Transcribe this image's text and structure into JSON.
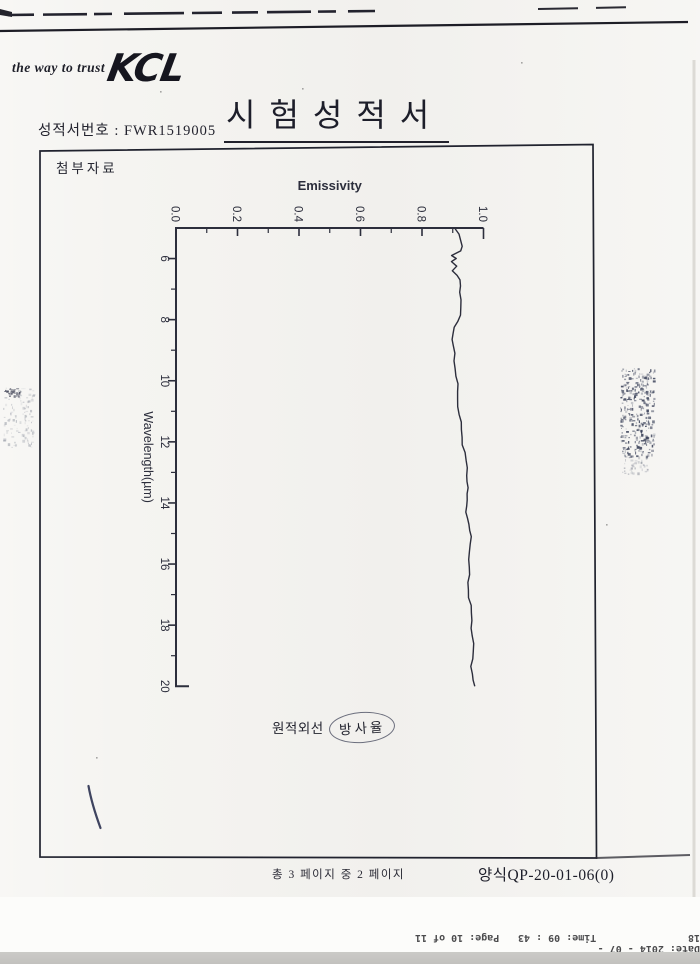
{
  "header": {
    "tagline": "the way to trust",
    "logo_text": "KCL",
    "report_no": "성적서번호 : FWR1519005",
    "title": "시험성적서"
  },
  "attachment_box": {
    "label": "첨부자료"
  },
  "chart_data": {
    "type": "line",
    "title": "",
    "orientation": "rotated: emissivity on top horizontal axis, wavelength on left vertical axis increasing downward",
    "emissivity_axis": {
      "label": "Emissivity",
      "ticks": [
        "0.0",
        "0.2",
        "0.4",
        "0.6",
        "0.8",
        "1.0"
      ],
      "range": [
        0.0,
        1.0
      ],
      "minor_step": 0.1,
      "position": "top"
    },
    "wavelength_axis": {
      "label": "Wavelength(µm)",
      "ticks": [
        "6",
        "8",
        "10",
        "12",
        "14",
        "16",
        "18",
        "20"
      ],
      "range": [
        5,
        20
      ],
      "minor_step": 1,
      "position": "left"
    },
    "grid": false,
    "series": [
      {
        "name": "far-infrared emissivity spectrum",
        "points": [
          [
            5.0,
            0.905
          ],
          [
            5.2,
            0.916
          ],
          [
            5.4,
            0.925
          ],
          [
            5.6,
            0.931
          ],
          [
            5.75,
            0.927
          ],
          [
            5.9,
            0.9
          ],
          [
            6.0,
            0.915
          ],
          [
            6.1,
            0.897
          ],
          [
            6.25,
            0.91
          ],
          [
            6.4,
            0.896
          ],
          [
            6.55,
            0.913
          ],
          [
            6.7,
            0.922
          ],
          [
            6.9,
            0.926
          ],
          [
            7.1,
            0.927
          ],
          [
            7.35,
            0.926
          ],
          [
            7.6,
            0.925
          ],
          [
            7.85,
            0.922
          ],
          [
            8.05,
            0.917
          ],
          [
            8.25,
            0.909
          ],
          [
            8.45,
            0.902
          ],
          [
            8.65,
            0.898
          ],
          [
            8.85,
            0.9
          ],
          [
            9.1,
            0.904
          ],
          [
            9.35,
            0.907
          ],
          [
            9.6,
            0.909
          ],
          [
            9.85,
            0.912
          ],
          [
            10.1,
            0.913
          ],
          [
            10.35,
            0.915
          ],
          [
            10.6,
            0.917
          ],
          [
            10.85,
            0.919
          ],
          [
            11.1,
            0.921
          ],
          [
            11.35,
            0.924
          ],
          [
            11.6,
            0.928
          ],
          [
            11.85,
            0.931
          ],
          [
            12.1,
            0.935
          ],
          [
            12.35,
            0.938
          ],
          [
            12.6,
            0.942
          ],
          [
            12.85,
            0.945
          ],
          [
            13.1,
            0.948
          ],
          [
            13.3,
            0.95
          ],
          [
            13.5,
            0.949
          ],
          [
            13.7,
            0.946
          ],
          [
            13.9,
            0.944
          ],
          [
            14.1,
            0.943
          ],
          [
            14.3,
            0.946
          ],
          [
            14.5,
            0.95
          ],
          [
            14.7,
            0.953
          ],
          [
            14.9,
            0.955
          ],
          [
            15.1,
            0.956
          ],
          [
            15.35,
            0.957
          ],
          [
            15.6,
            0.956
          ],
          [
            15.85,
            0.954
          ],
          [
            16.1,
            0.953
          ],
          [
            16.35,
            0.951
          ],
          [
            16.6,
            0.95
          ],
          [
            16.85,
            0.952
          ],
          [
            17.1,
            0.955
          ],
          [
            17.35,
            0.957
          ],
          [
            17.6,
            0.959
          ],
          [
            17.85,
            0.961
          ],
          [
            18.1,
            0.963
          ],
          [
            18.35,
            0.965
          ],
          [
            18.6,
            0.966
          ],
          [
            18.85,
            0.965
          ],
          [
            19.1,
            0.964
          ],
          [
            19.35,
            0.963
          ],
          [
            19.6,
            0.964
          ],
          [
            19.8,
            0.966
          ],
          [
            20.0,
            0.969
          ]
        ]
      }
    ]
  },
  "annotation": {
    "text_prefix": "원적외선",
    "text_circled": "방사율"
  },
  "footer": {
    "page_info": "총 3 페이지 중 2 페이지",
    "form_no": "양식QP-20-01-06(0)"
  },
  "fax_footer": {
    "page": "Page: 10 of 11",
    "time": "Time: 09 : 43",
    "date": "Date: 2014 - 07 - 18"
  },
  "colors": {
    "paper": "#f5f4f1",
    "ink": "#23242e",
    "chart_ink": "#2c2e3c",
    "stamp": "#394058",
    "bottom_band": "#c8c7c4"
  }
}
